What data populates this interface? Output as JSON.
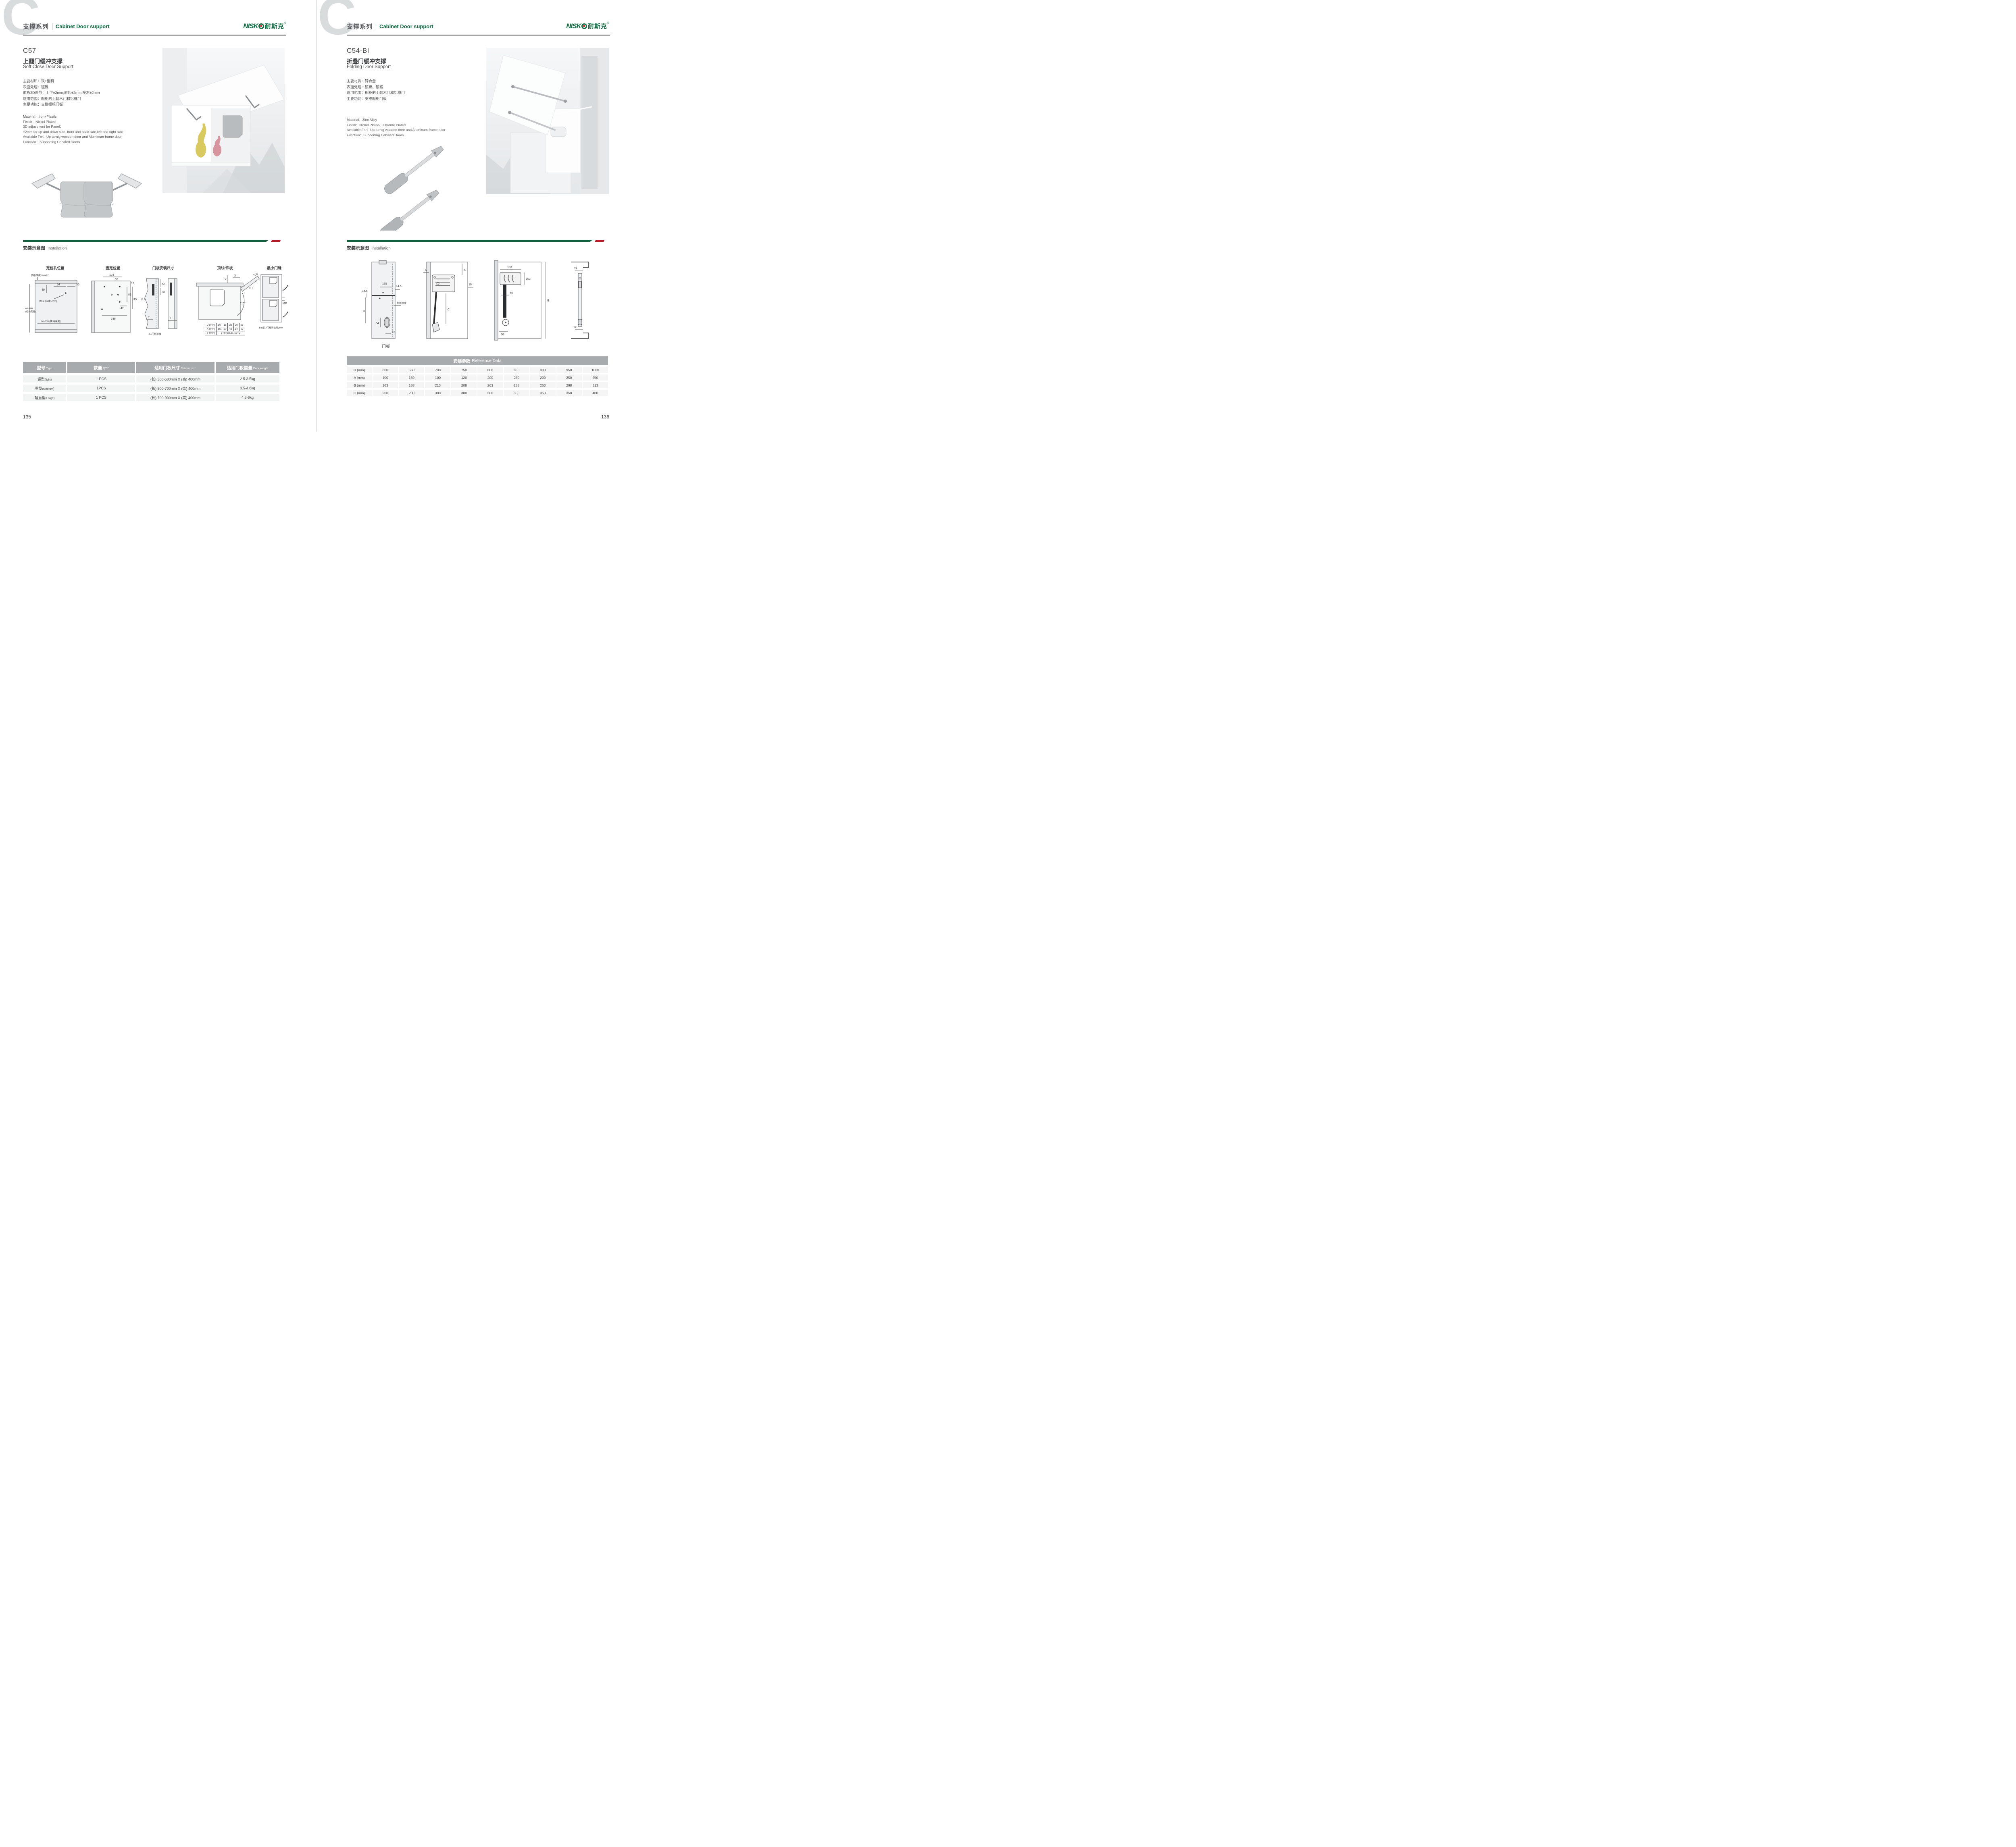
{
  "colors": {
    "brand_green": "#0e6b41",
    "bar_green": "#175f3e",
    "accent_red": "#b02025",
    "table_header_gray": "#a8abad",
    "row_gray": "#f3f4f4",
    "watermark_gray": "#d9dcdd"
  },
  "brand": {
    "logo_full": "NISKO",
    "logo_prefix": "NISK",
    "logo_cn": "耐斯克",
    "registered": "®"
  },
  "pages": [
    {
      "number": "135",
      "header": {
        "letter": "C",
        "series_cn": "支撑系列",
        "series_en": "Cabinet Door support"
      },
      "product": {
        "code": "C57",
        "name_cn": "上翻门缓冲支撑",
        "name_en": "Soft Close Door Support",
        "specs_cn": [
          "主要材质：铁+塑料",
          "表面处理：镀镍",
          "面板3D调节：上下±2mm,前后±2mm,左右±2mm",
          "适用范围：橱柜的上翻木门和铝框门",
          "主要功能：支撑橱柜门板"
        ],
        "specs_en": [
          "Material：Iron+Plastic",
          "Finish：Nickel Plated",
          "3D adjustment for Panel：",
          "±2mm for up and down side, front and back side,left and right side",
          "Available For：Up-turnig wooden door and Aluminum-frame door",
          "Function：Supoorting Cabined Doors"
        ]
      },
      "installation": {
        "title_cn": "安装示意图",
        "title_en": "Installation",
        "diagrams": [
          {
            "title": "定位孔位置",
            "labels": [
              "顶板厚度 max22",
              "49",
              "64",
              "36",
              "Φ5.2 (深度5mm)",
              "min200",
              "(柜内高度)",
              "min230 (柜内深度)"
            ]
          },
          {
            "title": "固定位置",
            "labels": [
              "124",
              "52",
              "12",
              "81",
              "115",
              "42",
              "146"
            ]
          },
          {
            "title": "门板安装尺寸",
            "labels": [
              "53",
              "32",
              "12.5",
              "T",
              "T",
              "T=门板厚度"
            ]
          },
          {
            "title": "顶线/饰板",
            "labels": [
              "Y",
              "X",
              "D",
              "FH",
              "110°"
            ]
          },
          {
            "title": "最小门缝",
            "labels": [
              "MF",
              "Fm最小门缝开启时2mm"
            ]
          }
        ],
        "mini_table": {
          "rows": [
            [
              "D (mm)",
              "16",
              "18",
              "22",
              "26",
              "28"
            ],
            [
              "X (mm)",
              "55",
              "50",
              "42",
              "34",
              "29"
            ],
            [
              "Y (mm)",
              "Y=FHx0.31-15+D"
            ]
          ]
        }
      },
      "table": {
        "headers": [
          {
            "cn": "型号",
            "en": "Type"
          },
          {
            "cn": "数量",
            "en": "QTY"
          },
          {
            "cn": "适用门板尺寸",
            "en": "Cabinet size"
          },
          {
            "cn": "适用门板重量",
            "en": "Door weight"
          }
        ],
        "rows": [
          {
            "type_cn": "轻型",
            "type_en": "(light)",
            "qty": "1 PCS",
            "size": "(长) 300-500mm X (高) 400mm",
            "weight": "2.5-3.5kg"
          },
          {
            "type_cn": "重型",
            "type_en": "(Medium)",
            "qty": "1PCS",
            "size": "(长) 500-700mm X (高) 400mm",
            "weight": "3.5-4.8kg"
          },
          {
            "type_cn": "超重型",
            "type_en": "(Large)",
            "qty": "1 PCS",
            "size": "(长) 700-900mm X (高) 400mm",
            "weight": "4.8-6kg"
          }
        ]
      }
    },
    {
      "number": "136",
      "header": {
        "letter": "C",
        "series_cn": "支撑系列",
        "series_en": "Cabinet Door support"
      },
      "product": {
        "code": "C54-BI",
        "name_cn": "折叠门缓冲支撑",
        "name_en": "Folding Door Support",
        "specs_cn": [
          "主要材质：锌合金",
          "表面处理：镀镍、镀铬",
          "适用范围：橱柜的上翻木门和铝框门",
          "主要功能：支撑橱柜门板"
        ],
        "specs_en": [
          "Material：Zinc Alloy",
          "Finish：Nickel Plated、Chrome Plated",
          "Available For：Up-turnig wooden door and Aluminum-frame door",
          "Function：Supoorting Cabined Doors"
        ]
      },
      "installation": {
        "title_cn": "安装示意图",
        "title_en": "Installation",
        "diagrams": [
          {
            "caption": "门板",
            "labels": [
              "135",
              "14.5",
              "14.5",
              "B",
              "54",
              "12",
              "侧板厚度"
            ]
          },
          {
            "labels": [
              "5",
              "A",
              "19",
              "C"
            ]
          },
          {
            "labels": [
              "193",
              "102",
              "23",
              "H",
              "50"
            ]
          },
          {
            "labels": [
              "24",
              "12"
            ]
          }
        ]
      },
      "table": {
        "title_cn": "安装参数",
        "title_en": "Reference Data",
        "row_labels": [
          "H (mm)",
          "A (mm)",
          "B (mm)",
          "C (mm)"
        ],
        "values": [
          [
            "600",
            "650",
            "700",
            "750",
            "800",
            "850",
            "900",
            "950",
            "1000"
          ],
          [
            "100",
            "150",
            "100",
            "120",
            "200",
            "250",
            "200",
            "250",
            "250"
          ],
          [
            "163",
            "188",
            "213",
            "208",
            "263",
            "288",
            "263",
            "288",
            "313"
          ],
          [
            "200",
            "200",
            "300",
            "300",
            "300",
            "300",
            "350",
            "350",
            "400"
          ]
        ]
      }
    }
  ]
}
